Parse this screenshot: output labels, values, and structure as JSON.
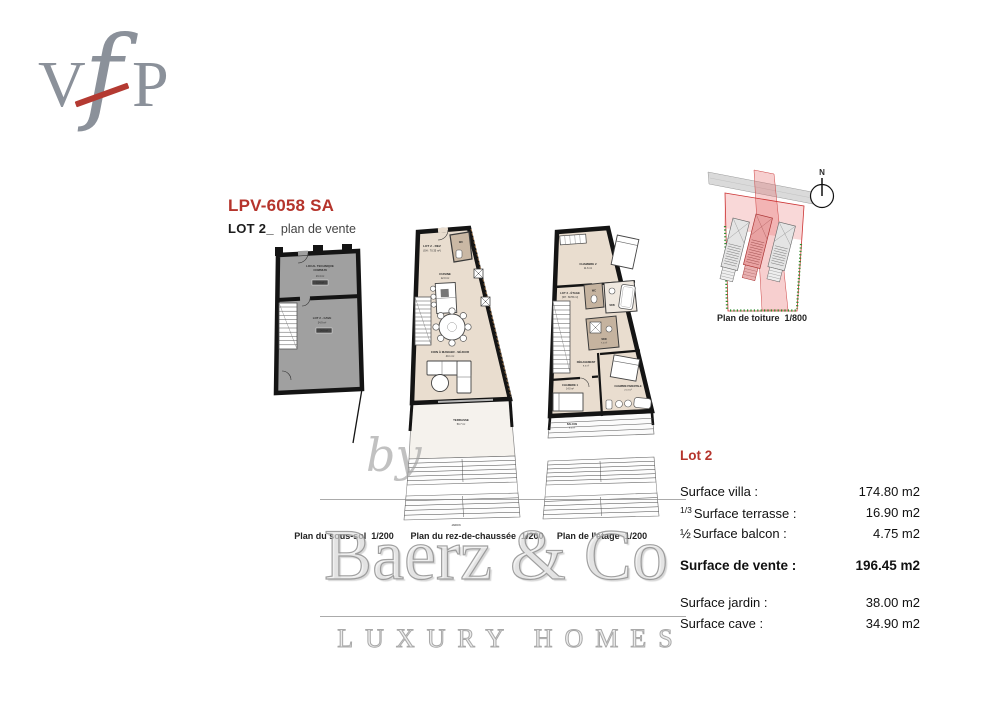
{
  "logo": {
    "v": "V",
    "f": "f",
    "p": "P"
  },
  "header": {
    "reference": "LPV-6058 SA",
    "lot": "LOT 2_",
    "subtitle": "plan de vente"
  },
  "colors": {
    "accent_red": "#b5342c",
    "wall_black": "#141414",
    "floor_beige": "#e9ddcf",
    "basement_gray": "#a0a0a0",
    "wet_room_brown": "#c5b39f",
    "site_boundary_red": "#cc3333",
    "hedge_green": "#2f8f2f"
  },
  "plans": {
    "sous_sol": {
      "caption": "Plan du sous-sol  1/200",
      "room1_line1": "LOCAL TECHNIQUE",
      "room1_line2": "COMMUN",
      "room1_area": "13.4 m²",
      "room1_badge": "13.4 m²",
      "room2_name": "LOT 2 - CAVE",
      "room2_area": "34.9 m²",
      "room2_badge": "34.9 m²"
    },
    "rez": {
      "caption": "Plan du rez-de-chaussée  1/200",
      "lot_label": "LOT 2 - REZ",
      "lot_area": "(SH : 70.35 m²)",
      "wc": "WC",
      "kitchen": "CUISINE",
      "kitchen_area": "12.0 m²",
      "living": "COIN À MANGER - SÉJOUR",
      "living_area": "40.1 m²",
      "terrace": "TERRASSE",
      "terrace_area": "50.7 m²",
      "garden": "JARDIN"
    },
    "etage": {
      "caption": "Plan de l'étage  1/200",
      "lot_label": "LOT 2 - ÉTAGE",
      "lot_area": "(SH : 69.55 m²)",
      "bedroom2": "CHAMBRE 2",
      "bedroom2_area": "11.6 m²",
      "wc": "WC",
      "bath": "SDB",
      "shower": "SDD",
      "shower_area": "7.2 m²",
      "hall": "DÉGAGEMENT",
      "hall_area": "9.3 m²",
      "bedroom1": "CHAMBRE 1",
      "bedroom1_area": "14.0 m²",
      "master": "CHAMBRE PARENTALE",
      "master_area": "21.3 m²",
      "balcony": "BALCON",
      "balcony_area": "9.5 m²"
    },
    "toiture": {
      "caption": "Plan de toiture  1/800",
      "north": "N"
    }
  },
  "surfaces": {
    "title": "Lot 2",
    "rows": [
      {
        "prefix": "",
        "label": "Surface villa :",
        "value": "174.80 m2"
      },
      {
        "prefix": "1/3",
        "label": "Surface terrasse :",
        "value": "16.90 m2"
      },
      {
        "prefix": "½",
        "label": "Surface balcon :",
        "value": "4.75 m2"
      },
      {
        "prefix": "",
        "label": "Surface de vente :",
        "value": "196.45 m2"
      },
      {
        "prefix": "",
        "label": "Surface jardin :",
        "value": "38.00 m2"
      },
      {
        "prefix": "",
        "label": "Surface cave :",
        "value": "34.90 m2"
      }
    ]
  },
  "watermark": {
    "by": "by",
    "brand": "Baerz & Co",
    "tagline": "LUXURY HOMES"
  }
}
